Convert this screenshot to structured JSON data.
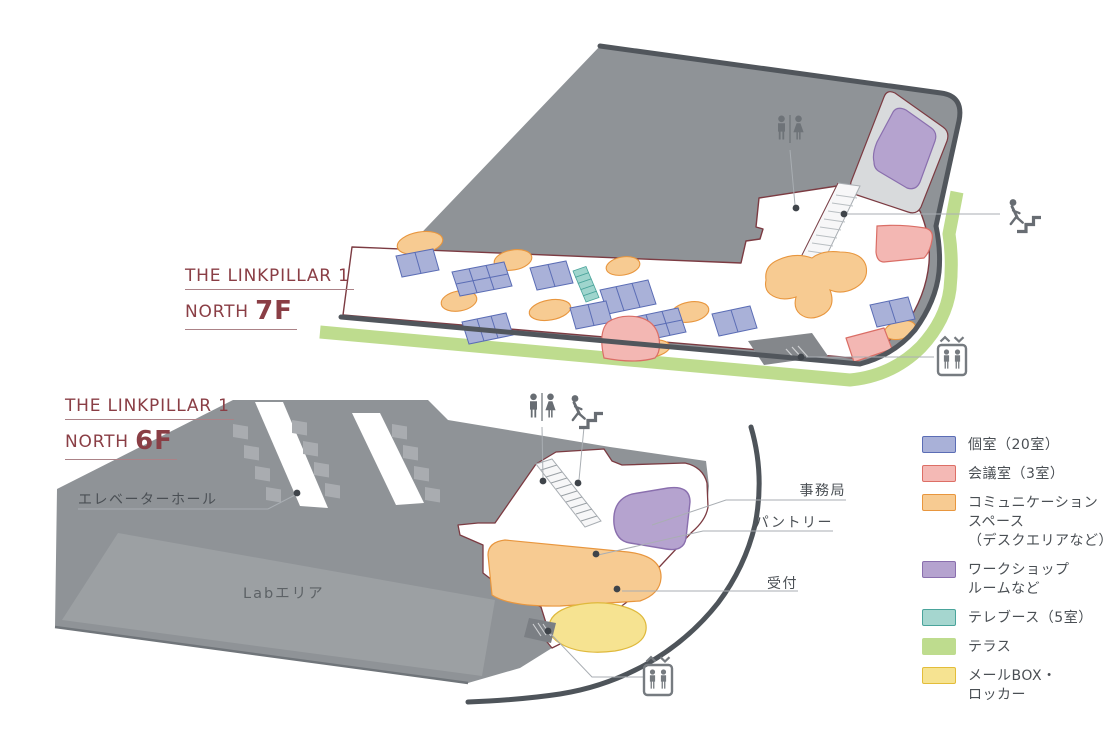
{
  "plans": [
    {
      "id": "f7",
      "building": "THE LINKPILLAR 1",
      "wing": "NORTH",
      "floor": "7F"
    },
    {
      "id": "f6",
      "building": "THE LINKPILLAR 1",
      "wing": "NORTH",
      "floor": "6F"
    }
  ],
  "labels": {
    "elevator_hall": "エレベーターホール",
    "lab_area": "Labエリア",
    "secretariat": "事務局",
    "pantry": "パントリー",
    "reception": "受付"
  },
  "legend": {
    "items": [
      {
        "label": "個室（20室）",
        "color": "#a9b1d8",
        "border": "#5b6db5"
      },
      {
        "label": "会議室（3室）",
        "color": "#f4b9b5",
        "border": "#dd6f66"
      },
      {
        "label": "コミュニケーション\nスペース\n（デスクエリアなど）",
        "color": "#f7cb92",
        "border": "#e8963e"
      },
      {
        "label": "ワークショップ\nルームなど",
        "color": "#b5a3cf",
        "border": "#8a6fae"
      },
      {
        "label": "テレブース（5室）",
        "color": "#a5d6cf",
        "border": "#4aa49b"
      },
      {
        "label": "テラス",
        "color": "#bedc8e",
        "border": "#bedc8e"
      },
      {
        "label": "メールBOX・\nロッカー",
        "color": "#f6e391",
        "border": "#e3bd3a"
      }
    ]
  },
  "icons": {
    "restroom": "restroom-icon",
    "stairs": "stairs-icon",
    "elevator": "elevator-icon"
  },
  "palette": {
    "title_maroon": "#8a3e45",
    "plan_outline_maroon": "#7c3b42",
    "building_edge": "#51565c",
    "roof_gray": "#8f9397",
    "lab_gray": "#9ca0a3",
    "terrace_green": "#bedc8e",
    "label_gray": "#4a4f54"
  }
}
